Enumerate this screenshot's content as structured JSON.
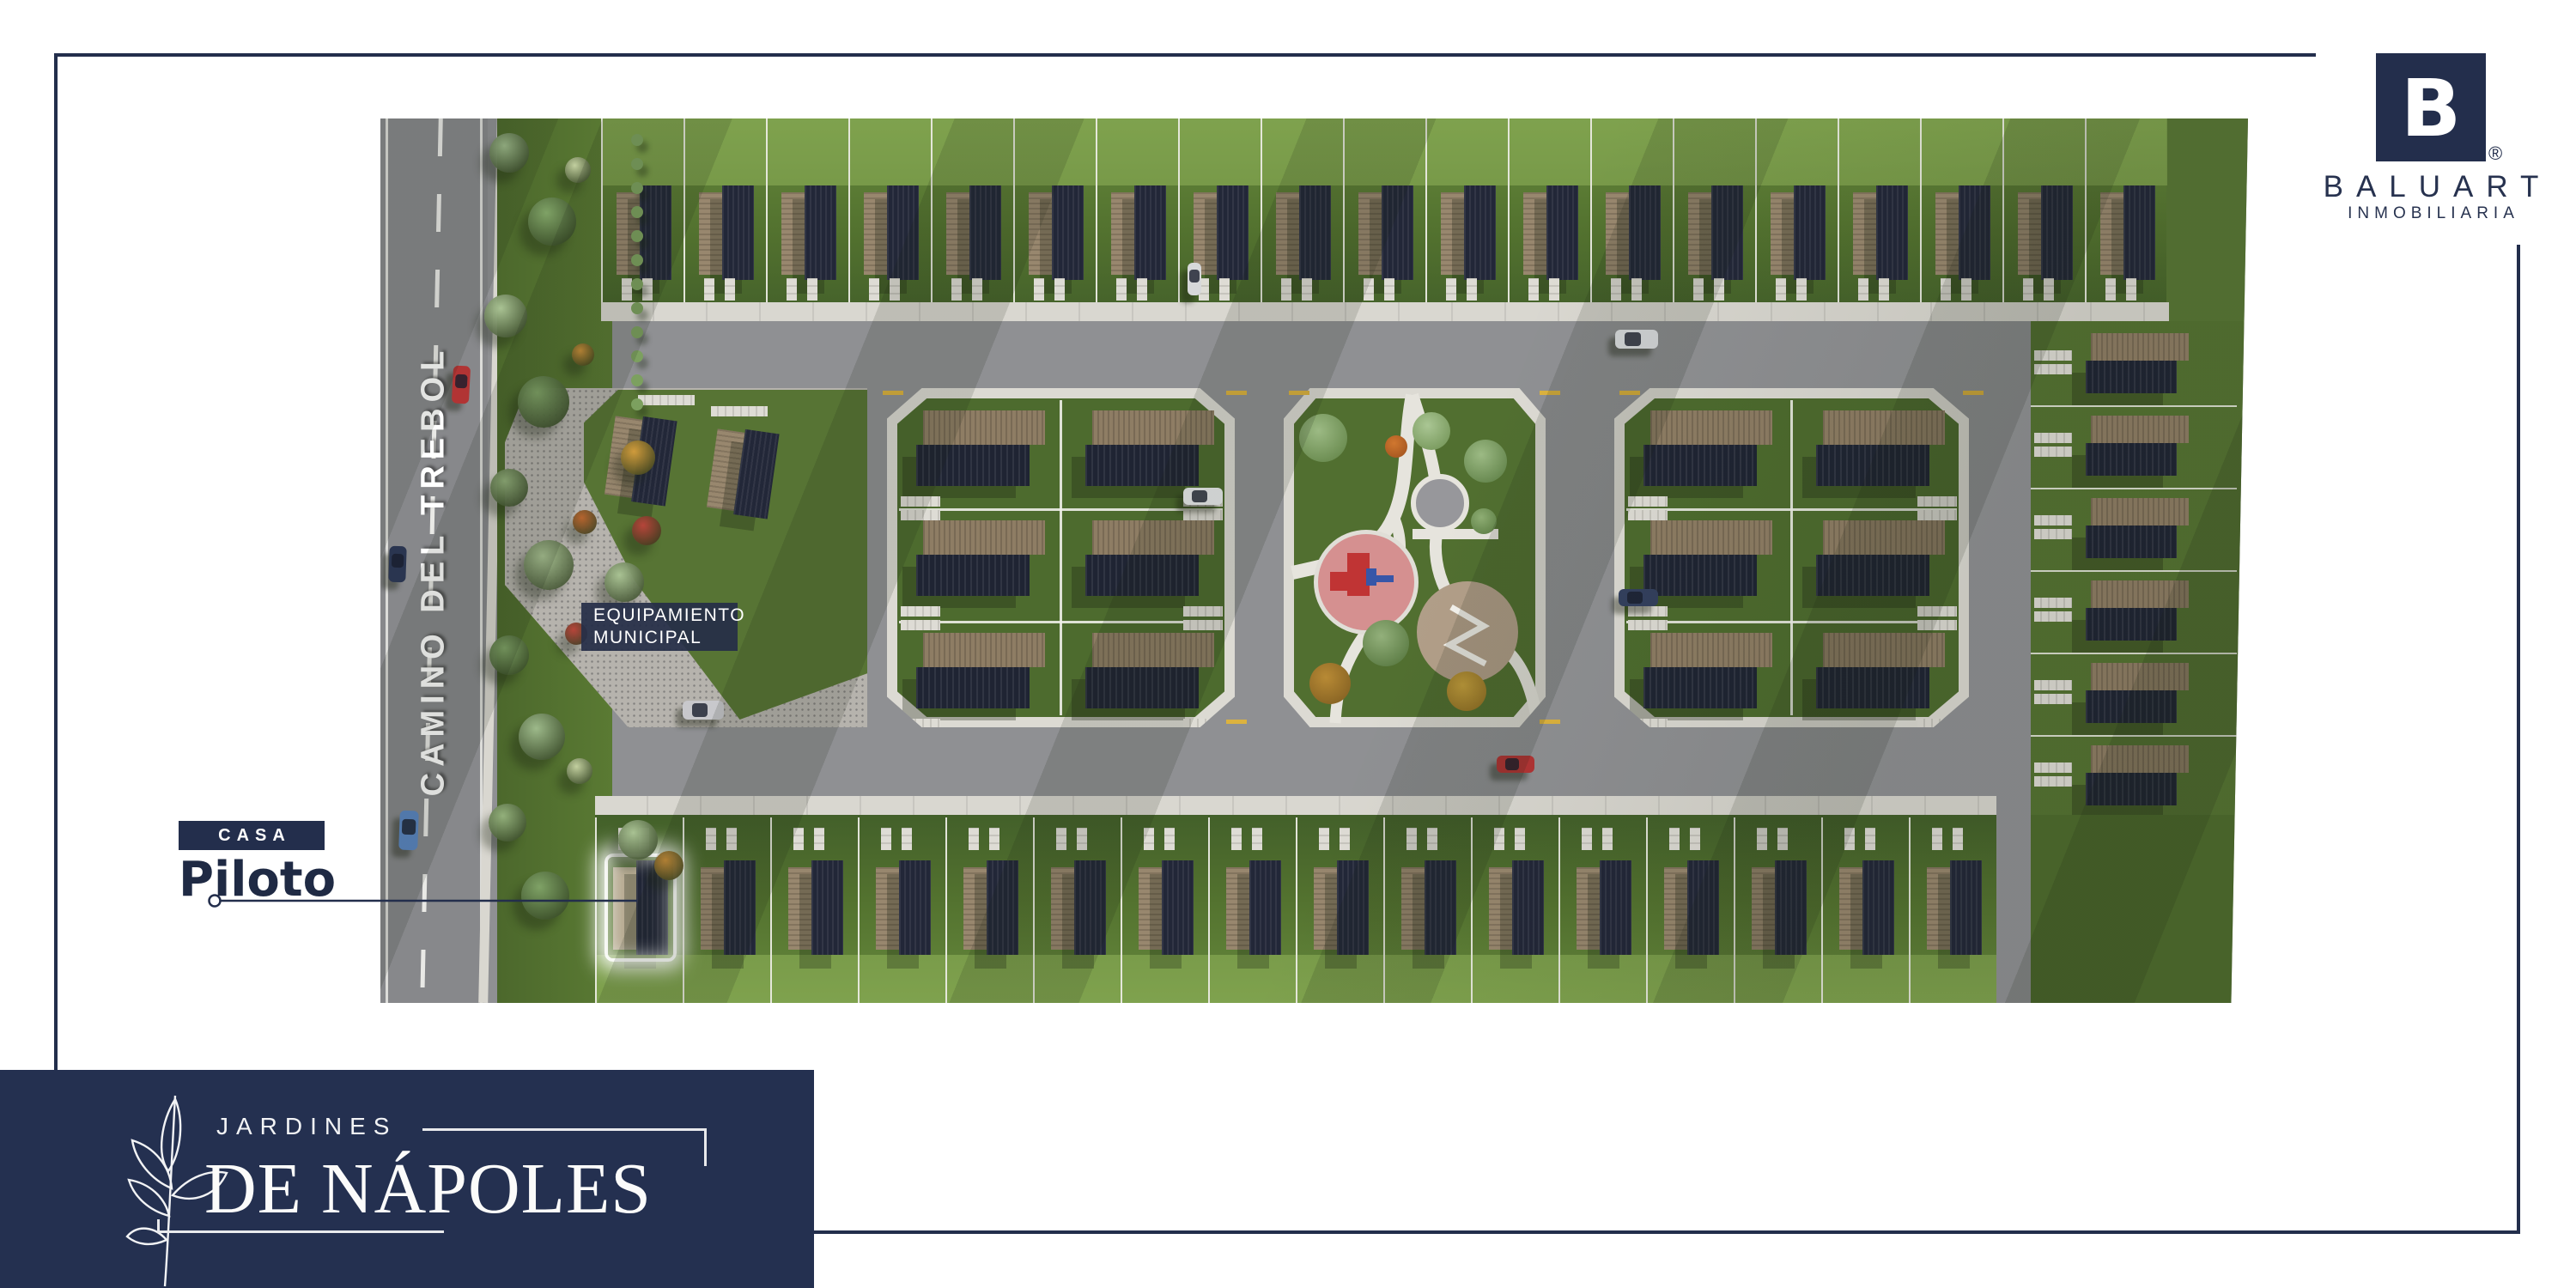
{
  "brand": {
    "logo_letter": "B",
    "registered_mark": "®",
    "name": "BALUART",
    "tagline": "INMOBILIARIA",
    "navy": "#232e4c"
  },
  "project": {
    "name_line1": "JARDINES",
    "name_line2": "DE NÁPOLES"
  },
  "site_plan": {
    "street_label": "CAMINO DEL TREBOL",
    "municipal_label_line1": "EQUIPAMIENTO",
    "municipal_label_line2": "MUNICIPAL",
    "pilot_home": {
      "badge": "CASA",
      "label": "Piloto"
    },
    "layout": {
      "top_row_lots": 19,
      "bottom_row_lots": 16,
      "cluster_rows": 3,
      "cluster_cols": 2,
      "right_column_lots": 6
    },
    "colors": {
      "grass_dark": "#43602a",
      "grass_mid": "#53722f",
      "grass_light": "#66893c",
      "road": "#8f9093",
      "sidewalk": "#d9d7d0",
      "roof_tan": "#98876e",
      "roof_dark": "#222738",
      "gravel": "#b6b3ad",
      "playground": "#d59090",
      "palapa": "#b19e88"
    }
  }
}
